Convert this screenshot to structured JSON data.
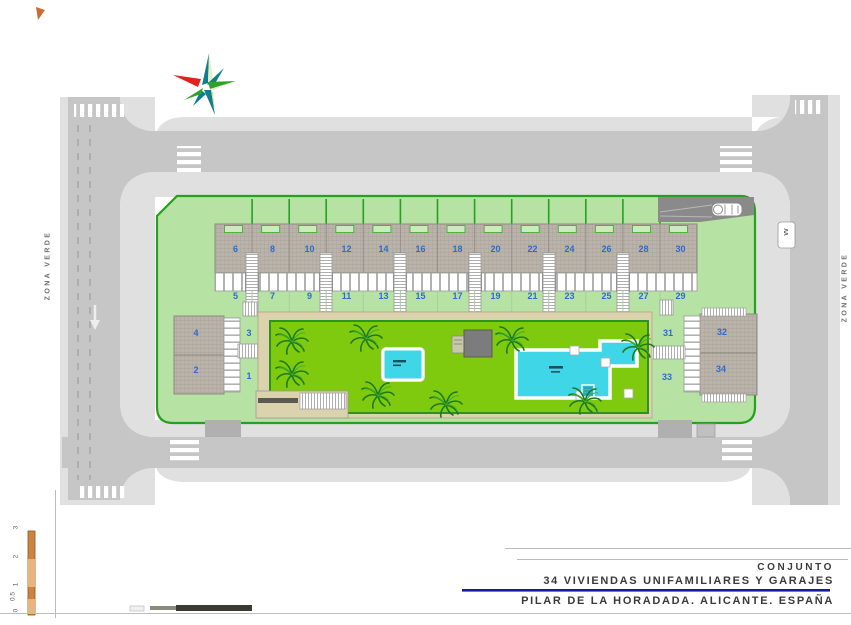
{
  "title_block": {
    "project": "CONJUNTO",
    "subtitle": "34 VIVIENDAS UNIFAMILIARES Y GARAJES",
    "location": "PILAR DE LA HORADADA. ALICANTE. ESPAÑA"
  },
  "zones": {
    "left": "ZONA VERDE",
    "right": "ZONA VERDE"
  },
  "road": {
    "parked_label": "VV"
  },
  "scale": {
    "vertical_ticks": [
      "3",
      "2",
      "1",
      "0.5",
      "0"
    ]
  },
  "houses": {
    "row_top": [
      "6",
      "8",
      "10",
      "12",
      "14",
      "16",
      "18",
      "20",
      "22",
      "24",
      "26",
      "28",
      "30"
    ],
    "row_bottom": [
      "5",
      "7",
      "9",
      "11",
      "13",
      "15",
      "17",
      "19",
      "21",
      "23",
      "25",
      "27",
      "29"
    ],
    "west": {
      "roof_upper": "4",
      "roof_lower": "2",
      "plot_upper": "3",
      "plot_lower": "1"
    },
    "east": {
      "plot_upper": "31",
      "roof_upper": "32",
      "plot_lower": "33",
      "roof_lower": "34"
    }
  },
  "colors": {
    "site_green": "#b6e2a4",
    "border_green": "#27a021",
    "lawn_green": "#7fca0e",
    "pool_cyan": "#3fd6e8",
    "road_gray": "#c6c6c6",
    "sidewalk_gray": "#e0e0e0",
    "roof_gray": "#b9b3ab",
    "number_blue": "#2e6bcd",
    "title_underline_blue": "#1717a8",
    "scale_orange": "#cd8440",
    "ramp_gray": "#8a8a8a"
  }
}
